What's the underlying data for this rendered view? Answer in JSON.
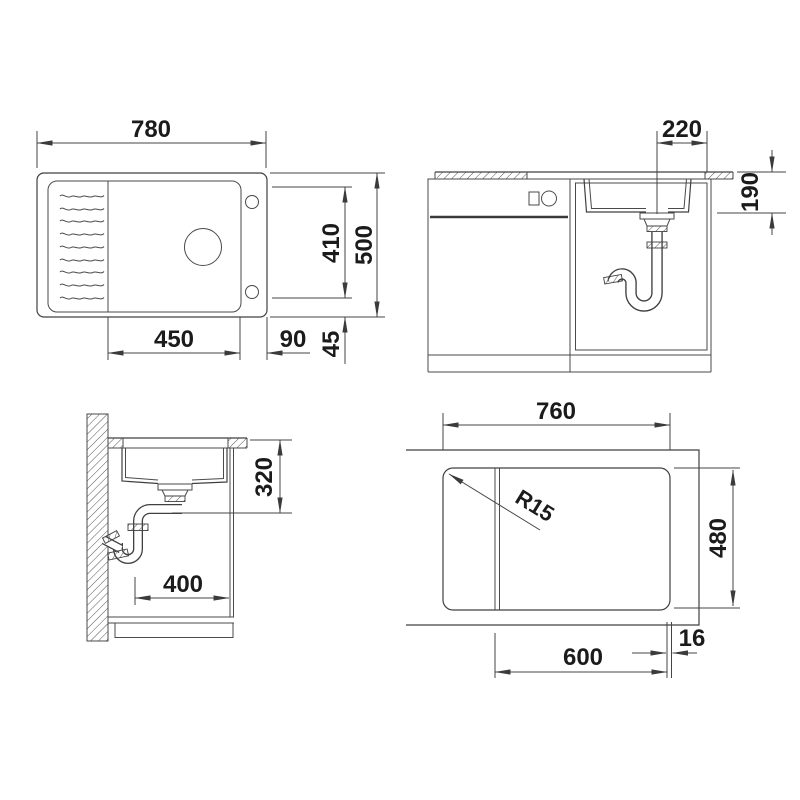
{
  "colors": {
    "line": "#404040",
    "text": "#1b1b1b",
    "background": "#ffffff"
  },
  "views": {
    "plan": {
      "overall_width": "780",
      "overall_depth": "500",
      "bowl_length": "410",
      "bowl_width": "450",
      "tap_ledge_width": "90",
      "edge_inset": "45"
    },
    "front_section": {
      "drain_to_edge": "220",
      "bowl_depth": "190"
    },
    "side_section": {
      "worktop_to_outlet": "320",
      "wall_to_front": "400"
    },
    "cutout": {
      "cutout_width": "760",
      "cutout_depth": "480",
      "cabinet_width": "600",
      "panel_thickness": "16",
      "corner_radius": "R15"
    }
  }
}
